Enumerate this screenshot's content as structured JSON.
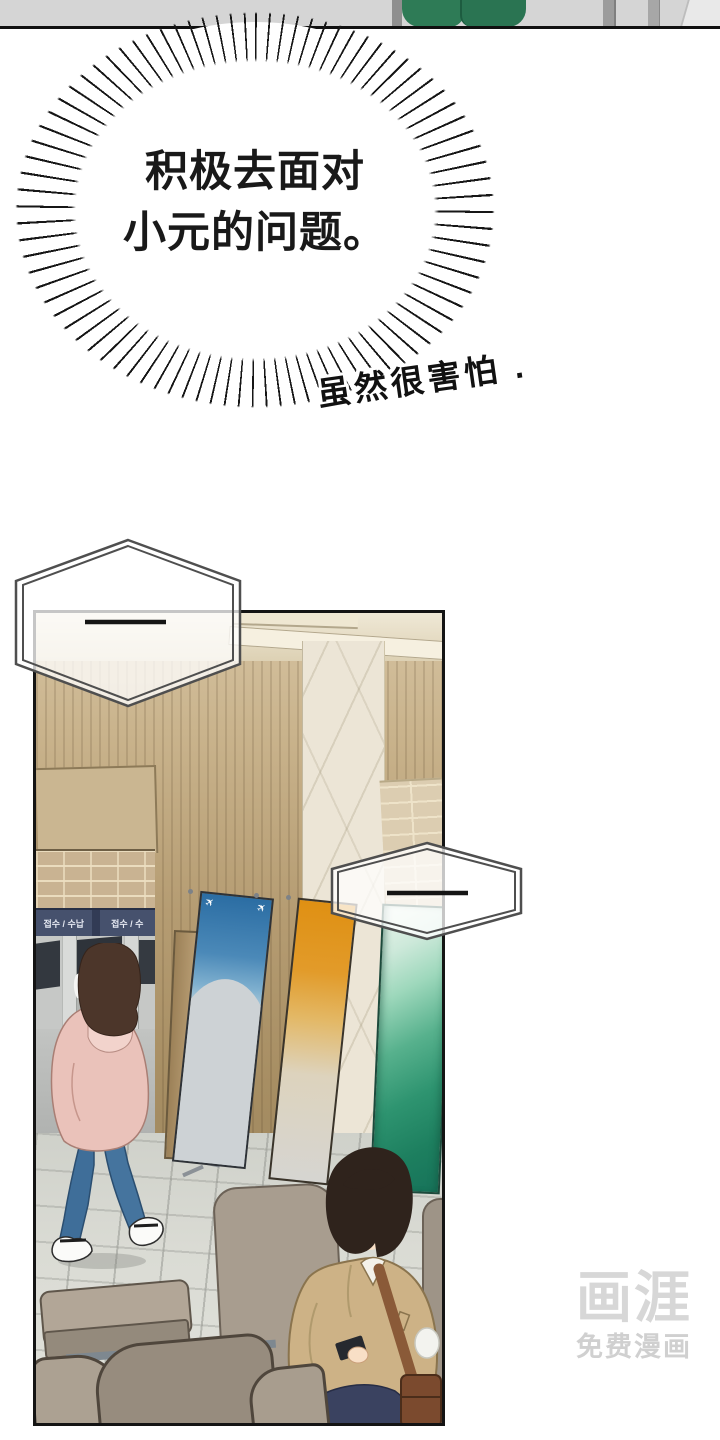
{
  "burst_bubble": {
    "lines": [
      "积极去面对",
      "小元的问题。"
    ]
  },
  "handwritten_aside": "虽然很害怕 .",
  "scene_panel": {
    "counter_sign": {
      "segments": [
        "접수 / 수납",
        "접수 / 수"
      ],
      "color_navy": "#46516d"
    },
    "blue_banner": {
      "plane_icon": "✈",
      "color": "#2b6da3"
    },
    "orange_banner": {
      "color": "#df9013"
    },
    "green_banner": {
      "color": "#2e9470"
    }
  },
  "watermark": {
    "logo": "画涯",
    "tagline": "免费漫画"
  },
  "colors": {
    "wall_tan": "#b59c72",
    "marble": "#ece5d6",
    "floor_gray": "#d7d8d2",
    "jacket_pink": "#eac2ba",
    "jeans_blue": "#3f6e99",
    "coat_tan": "#cdb286",
    "bag_brown": "#7b4a2e",
    "watermark_gray": "#d7d7d7"
  }
}
